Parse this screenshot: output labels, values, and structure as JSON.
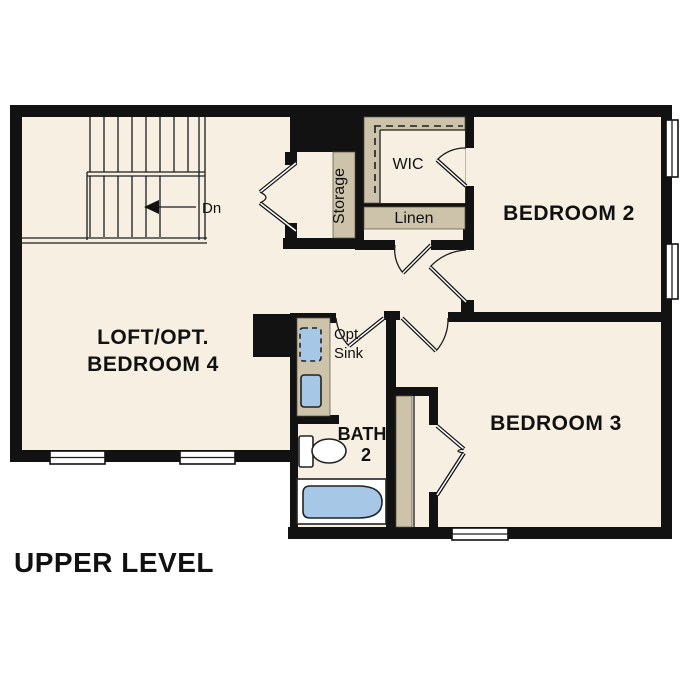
{
  "plan": {
    "title": "UPPER LEVEL",
    "colors": {
      "paper": "#ffffff",
      "floor": "#f6efe2",
      "wall": "#121212",
      "cabinet": "#cdc3aa",
      "fixture": "#a6c7e5",
      "line": "#1d1d1d"
    },
    "rooms": {
      "loft": {
        "label1": "LOFT/OPT.",
        "label2": "BEDROOM 4"
      },
      "bedroom2": {
        "label": "BEDROOM 2"
      },
      "bedroom3": {
        "label": "BEDROOM 3"
      },
      "bath": {
        "label1": "BATH",
        "label2": "2"
      },
      "wic": {
        "label": "WIC"
      },
      "linen": {
        "label": "Linen"
      },
      "storage": {
        "label": "Storage"
      }
    },
    "annotations": {
      "stairs": "Dn",
      "opt_sink1": "Opt.",
      "opt_sink2": "Sink"
    }
  }
}
